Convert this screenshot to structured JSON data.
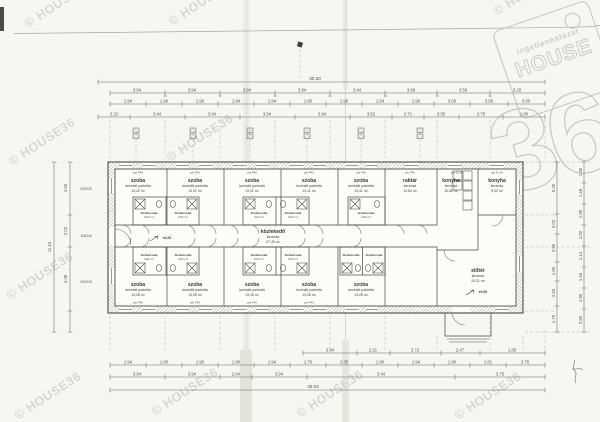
{
  "watermark": {
    "text": "© HOUSE36"
  },
  "logo": {
    "brand_top": "ingatlanhálózat",
    "brand_main": "HOUSE",
    "brand_number": "36"
  },
  "plan": {
    "level_marker": "±0,00",
    "header_room": "pfa P40",
    "header_kitchen": "pfa 61.90",
    "corridor": {
      "name": "közlekedő",
      "finish": "kerámia",
      "area": "27,45 m²"
    },
    "bathroom": {
      "name": "fürdőszoba",
      "area": "3,61 m²"
    },
    "entry": {
      "name": "előtér",
      "finish": "kerámia",
      "area": "20,21 m²"
    },
    "rooms_top": [
      {
        "name": "szoba",
        "finish": "laminált parketta",
        "area": "13,42 m²"
      },
      {
        "name": "szoba",
        "finish": "laminált parketta",
        "area": "13,91 m²"
      },
      {
        "name": "szoba",
        "finish": "laminált parketta",
        "area": "13,91 m²"
      },
      {
        "name": "szoba",
        "finish": "laminált parketta",
        "area": "13,41 m²"
      },
      {
        "name": "szoba",
        "finish": "laminált parketta",
        "area": "13,41 m²"
      },
      {
        "name": "raktár",
        "finish": "kerámia",
        "area": "13,64 m²"
      },
      {
        "name": "konyha",
        "finish": "kerámia",
        "area": "15,86 m²"
      },
      {
        "name": "konyha",
        "finish": "kerámia",
        "area": "9,02 m²"
      }
    ],
    "rooms_bottom": [
      {
        "name": "szoba",
        "finish": "laminált parketta",
        "area": "13,28 m²"
      },
      {
        "name": "szoba",
        "finish": "laminált parketta",
        "area": "13,28 m²"
      },
      {
        "name": "szoba",
        "finish": "laminált parketta",
        "area": "13,28 m²"
      },
      {
        "name": "szoba",
        "finish": "laminált parketta",
        "area": "13,28 m²"
      },
      {
        "name": "szoba",
        "finish": "laminált parketta",
        "area": "13,28 m²"
      }
    ],
    "window_sizes": [
      "200/130",
      "115/240",
      "200/130"
    ]
  },
  "dimensions": {
    "tick": "10",
    "top_overall": "30.30",
    "top_row1": [
      "3.94",
      "3.94",
      "3.94",
      "3.94",
      "3.94",
      "3.90",
      "3.50",
      "3.20"
    ],
    "top_row2": [
      "1.94",
      "1.90",
      "1.90",
      "1.94",
      "1.94",
      "1.90",
      "1.90",
      "1.94",
      "1.90",
      "3.00",
      "3.50",
      "3.00"
    ],
    "top_row3": [
      "2.22",
      "3.94",
      "3.94",
      "3.94",
      "3.94",
      "3.52",
      "2.71",
      "3.30",
      "2.75",
      "1.80"
    ],
    "bottom_row1": [
      "3.94",
      "2.31",
      "3.72",
      "2.47",
      "1.85"
    ],
    "bottom_row2": [
      "1.94",
      "1.80",
      "1.90",
      "1.90",
      "1.94",
      "1.70",
      "2.35",
      "1.90",
      "1.94",
      "1.90",
      "1.81",
      "3.75"
    ],
    "bottom_row3": [
      "3.94",
      "3.94",
      "2.04",
      "3.94",
      "3.44",
      "3.75"
    ],
    "bottom_overall": "30.02",
    "left_col": [
      "4.50",
      "2.02",
      "4.38"
    ],
    "left_overall": "11.10",
    "right_col1": [
      "5.25",
      "2.02",
      "2.95",
      "1.90",
      "2.50",
      "1.75"
    ],
    "right_col2": [
      "1.36",
      "1.48",
      "1.90",
      "1.00",
      "1.14",
      "1.45",
      "1.90",
      "2.50"
    ]
  }
}
